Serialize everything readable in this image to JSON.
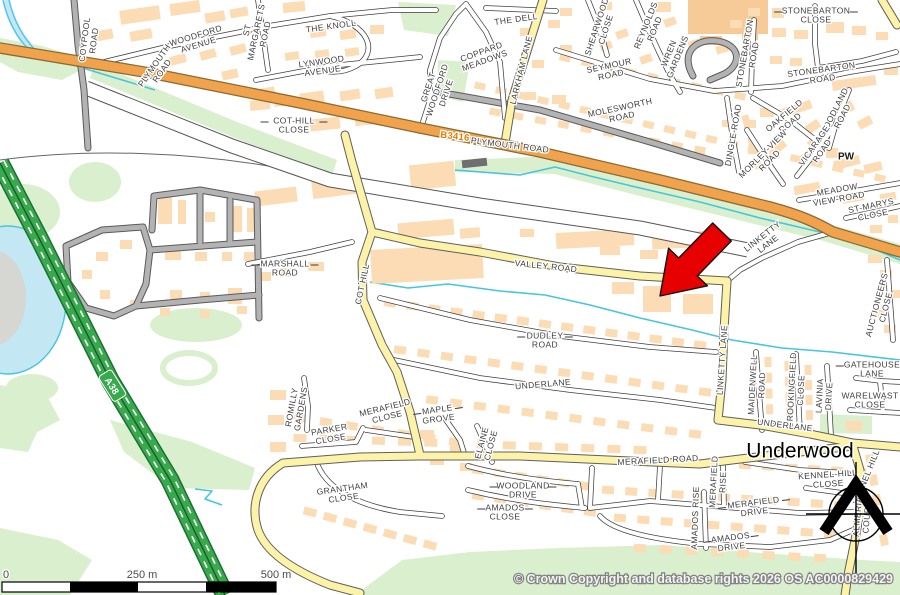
{
  "map": {
    "title": "Street map with highlighted location",
    "labels": [
      {
        "text": "COYPOOL\nROAD",
        "x": 89,
        "y": 40,
        "r": -83
      },
      {
        "text": "PLYMOUTH\nROAD",
        "x": 158,
        "y": 68,
        "r": -55
      },
      {
        "text": "WOODFORD\nAVENUE",
        "x": 197,
        "y": 40,
        "r": -17
      },
      {
        "text": "ST\nMARGARETS\nROAD",
        "x": 256,
        "y": 32,
        "r": -78
      },
      {
        "text": "THE KNOLL",
        "x": 331,
        "y": 26,
        "r": -8
      },
      {
        "text": "LYNWOOD\nAVENUE",
        "x": 322,
        "y": 66,
        "r": -8
      },
      {
        "text": "COT-HILL\nCLOSE",
        "x": 294,
        "y": 125,
        "r": 0,
        "lead": true
      },
      {
        "text": "GREAT\nWOODFORD\nDRIVE",
        "x": 437,
        "y": 90,
        "r": -72
      },
      {
        "text": "COPPARD\nMEADOWS",
        "x": 483,
        "y": 56,
        "r": -20
      },
      {
        "text": "THE DELL",
        "x": 516,
        "y": 19,
        "r": -8
      },
      {
        "text": "LARKHAM LANE",
        "x": 521,
        "y": 70,
        "r": -76
      },
      {
        "text": "SHEARWOOD\nCLOSE",
        "x": 601,
        "y": 28,
        "r": -72
      },
      {
        "text": "REYNOLDS\nROAD",
        "x": 650,
        "y": 27,
        "r": -68
      },
      {
        "text": "WREN\nGARDENS",
        "x": 673,
        "y": 55,
        "r": -68
      },
      {
        "text": "SEYMOUR\nROAD",
        "x": 610,
        "y": 70,
        "r": -12
      },
      {
        "text": "MOLESWORTH\nROAD",
        "x": 621,
        "y": 112,
        "r": -12
      },
      {
        "text": "STONEBARTON\nCLOSE",
        "x": 816,
        "y": 15,
        "r": 0,
        "lead": true
      },
      {
        "text": "STONEBARTON\nROAD",
        "x": 749,
        "y": 54,
        "r": -80
      },
      {
        "text": "STONEBARTON\nROAD",
        "x": 822,
        "y": 74,
        "r": -8
      },
      {
        "text": "OAKFIELD\nROAD",
        "x": 787,
        "y": 119,
        "r": -40
      },
      {
        "text": "WOODLAND\nROAD",
        "x": 838,
        "y": 114,
        "r": -63
      },
      {
        "text": "MORLEY-VIEW\nROAD",
        "x": 766,
        "y": 157,
        "r": -45
      },
      {
        "text": "VICARAGE\nROAD",
        "x": 818,
        "y": 148,
        "r": -55
      },
      {
        "text": "PW",
        "x": 846,
        "y": 156,
        "r": 0,
        "kind": "bold",
        "s": 10
      },
      {
        "text": "DINGLE ROAD",
        "x": 733,
        "y": 135,
        "r": -80
      },
      {
        "text": "MEADOW\nVIEW-ROAD",
        "x": 838,
        "y": 194,
        "r": -10
      },
      {
        "text": "ST-MARYS\nCLOSE",
        "x": 872,
        "y": 210,
        "r": -12
      },
      {
        "text": "MARSHALL\nROAD",
        "x": 285,
        "y": 268,
        "r": 0,
        "lead": true
      },
      {
        "text": "COT HILL",
        "x": 362,
        "y": 284,
        "r": -78
      },
      {
        "text": "VALLEY ROAD",
        "x": 546,
        "y": 266,
        "r": 6
      },
      {
        "text": "DUDLEY\nROAD",
        "x": 545,
        "y": 340,
        "r": 0,
        "lead": true
      },
      {
        "text": "UNDERLANE",
        "x": 543,
        "y": 384,
        "r": -5
      },
      {
        "text": "LINKETTY\nLANE",
        "x": 765,
        "y": 240,
        "r": -38
      },
      {
        "text": "LINKETTY LANE",
        "x": 722,
        "y": 360,
        "r": -86
      },
      {
        "text": "AUCTIONEERS\nCLOSE",
        "x": 881,
        "y": 306,
        "r": -75
      },
      {
        "text": "GATEHOUSE\nLANE",
        "x": 872,
        "y": 369,
        "r": 0,
        "lead": true
      },
      {
        "text": "MAIDENWELL\nROAD",
        "x": 757,
        "y": 385,
        "r": -87
      },
      {
        "text": "BROOKINGFIELD\nCLOSE",
        "x": 796,
        "y": 390,
        "r": -87
      },
      {
        "text": "LAVINIA\nDRIVE",
        "x": 824,
        "y": 396,
        "r": -87
      },
      {
        "text": "WARELWAST\nCLOSE",
        "x": 870,
        "y": 400,
        "r": 0
      },
      {
        "text": "UNDERLANE",
        "x": 785,
        "y": 425,
        "r": 7
      },
      {
        "text": "Underwood",
        "x": 800,
        "y": 450,
        "r": 0,
        "kind": "place",
        "s": 21
      },
      {
        "text": "MERAFIELD ROAD",
        "x": 658,
        "y": 460,
        "r": -3
      },
      {
        "text": "MERAFIELD\nRISE",
        "x": 718,
        "y": 482,
        "r": -87
      },
      {
        "text": "MERAFIELD\nDRIVE",
        "x": 754,
        "y": 507,
        "r": -7,
        "lead": true
      },
      {
        "text": "AMADOS RISE",
        "x": 695,
        "y": 518,
        "r": -88
      },
      {
        "text": "AMADOS\nDRIVE",
        "x": 731,
        "y": 542,
        "r": -7,
        "lead": true
      },
      {
        "text": "KENNEL-HILL\nCLOSE",
        "x": 828,
        "y": 479,
        "r": -4
      },
      {
        "text": "KENNEL HILL",
        "x": 866,
        "y": 477,
        "r": -68
      },
      {
        "text": "ALMERIA\nCOURT",
        "x": 862,
        "y": 517,
        "r": -85
      },
      {
        "text": "ROMILLY\nGARDENS",
        "x": 296,
        "y": 408,
        "r": -80
      },
      {
        "text": "PARKER\nCLOSE",
        "x": 330,
        "y": 434,
        "r": -10
      },
      {
        "text": "MERAFIELD\nCLOSE",
        "x": 386,
        "y": 412,
        "r": -14
      },
      {
        "text": "MAPLE\nGROVE",
        "x": 438,
        "y": 414,
        "r": -8,
        "lead": true
      },
      {
        "text": "ELAINE\nCLOSE",
        "x": 486,
        "y": 444,
        "r": -75
      },
      {
        "text": "GRANTHAM\nCLOSE",
        "x": 343,
        "y": 493,
        "r": -8
      },
      {
        "text": "WOODLAND\nDRIVE",
        "x": 523,
        "y": 490,
        "r": 0,
        "lead": true
      },
      {
        "text": "AMADOS\nCLOSE",
        "x": 505,
        "y": 512,
        "r": 0,
        "lead": true
      },
      {
        "text": "B3416",
        "x": 455,
        "y": 136,
        "r": 7,
        "kind": "ref-b",
        "s": 9.5
      },
      {
        "text": "PLYMOUTH ROAD",
        "x": 510,
        "y": 145,
        "r": 7
      },
      {
        "text": "A38",
        "x": 112,
        "y": 386,
        "r": 58,
        "kind": "ref-a",
        "s": 9.5
      }
    ]
  },
  "marker": {
    "name": "red-arrow",
    "points_at": "building on Valley Road",
    "tip_x": 660,
    "tip_y": 296
  },
  "scale_bar": {
    "labels": [
      "0",
      "250 m",
      "500 m"
    ]
  },
  "attribution": "© Crown Copyright and database rights 2026 OS AC0000829429",
  "colors": {
    "background": "#ffffff",
    "vegetation": "#d9efcd",
    "water_fill": "#c3e7f3",
    "water_line": "#45c5de",
    "road_a_green": "#38a94c",
    "road_b_orange": "#f0a24c",
    "road_yellow": "#fcf2a8",
    "road_gray": "#b3b3b3",
    "building": "#fbdcb4",
    "building_dark": "#6f6f6f",
    "building_school": "#f7cb97",
    "marker_red": "#e60000",
    "label_text": "#3d3d3d"
  }
}
